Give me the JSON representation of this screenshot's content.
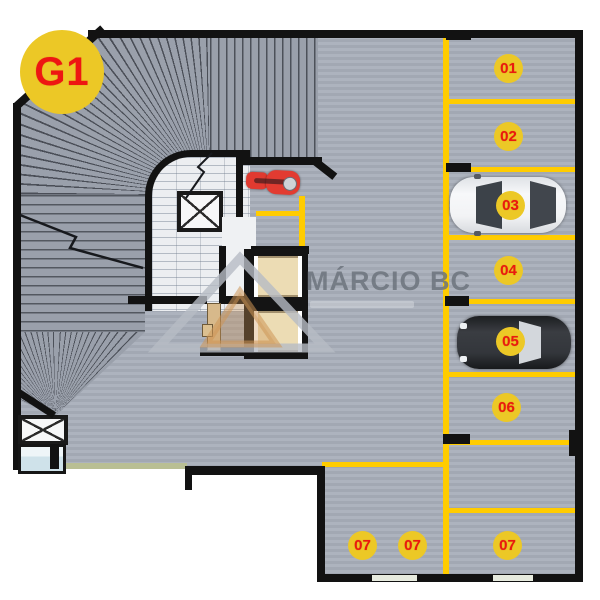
{
  "level_badge": {
    "label": "G1"
  },
  "watermark": {
    "brand": "MÁRCIO BC"
  },
  "spots": [
    {
      "id": "01",
      "label": "01",
      "occupied": false
    },
    {
      "id": "02",
      "label": "02",
      "occupied": false
    },
    {
      "id": "03",
      "label": "03",
      "occupied": true,
      "vehicle": "white-car"
    },
    {
      "id": "04",
      "label": "04",
      "occupied": false
    },
    {
      "id": "05",
      "label": "05",
      "occupied": true,
      "vehicle": "dark-car"
    },
    {
      "id": "06",
      "label": "06",
      "occupied": false
    },
    {
      "id": "07a",
      "label": "07",
      "occupied": false
    },
    {
      "id": "07b",
      "label": "07",
      "occupied": false
    },
    {
      "id": "07c",
      "label": "07",
      "occupied": false
    }
  ],
  "vehicles": {
    "moto": "red-motorcycle",
    "spot_03": "white-car-top-view",
    "spot_05": "dark-car-top-view"
  },
  "colors": {
    "floor": "#a9afba",
    "wall": "#121212",
    "marking_yellow": "#ffcc00",
    "badge_yellow": "#ecc826",
    "badge_red": "#ea1a0e",
    "stair_floor": "#eceef1",
    "elevator_cab": "#ecdcb4",
    "watermark_gray": "#6c737d"
  }
}
